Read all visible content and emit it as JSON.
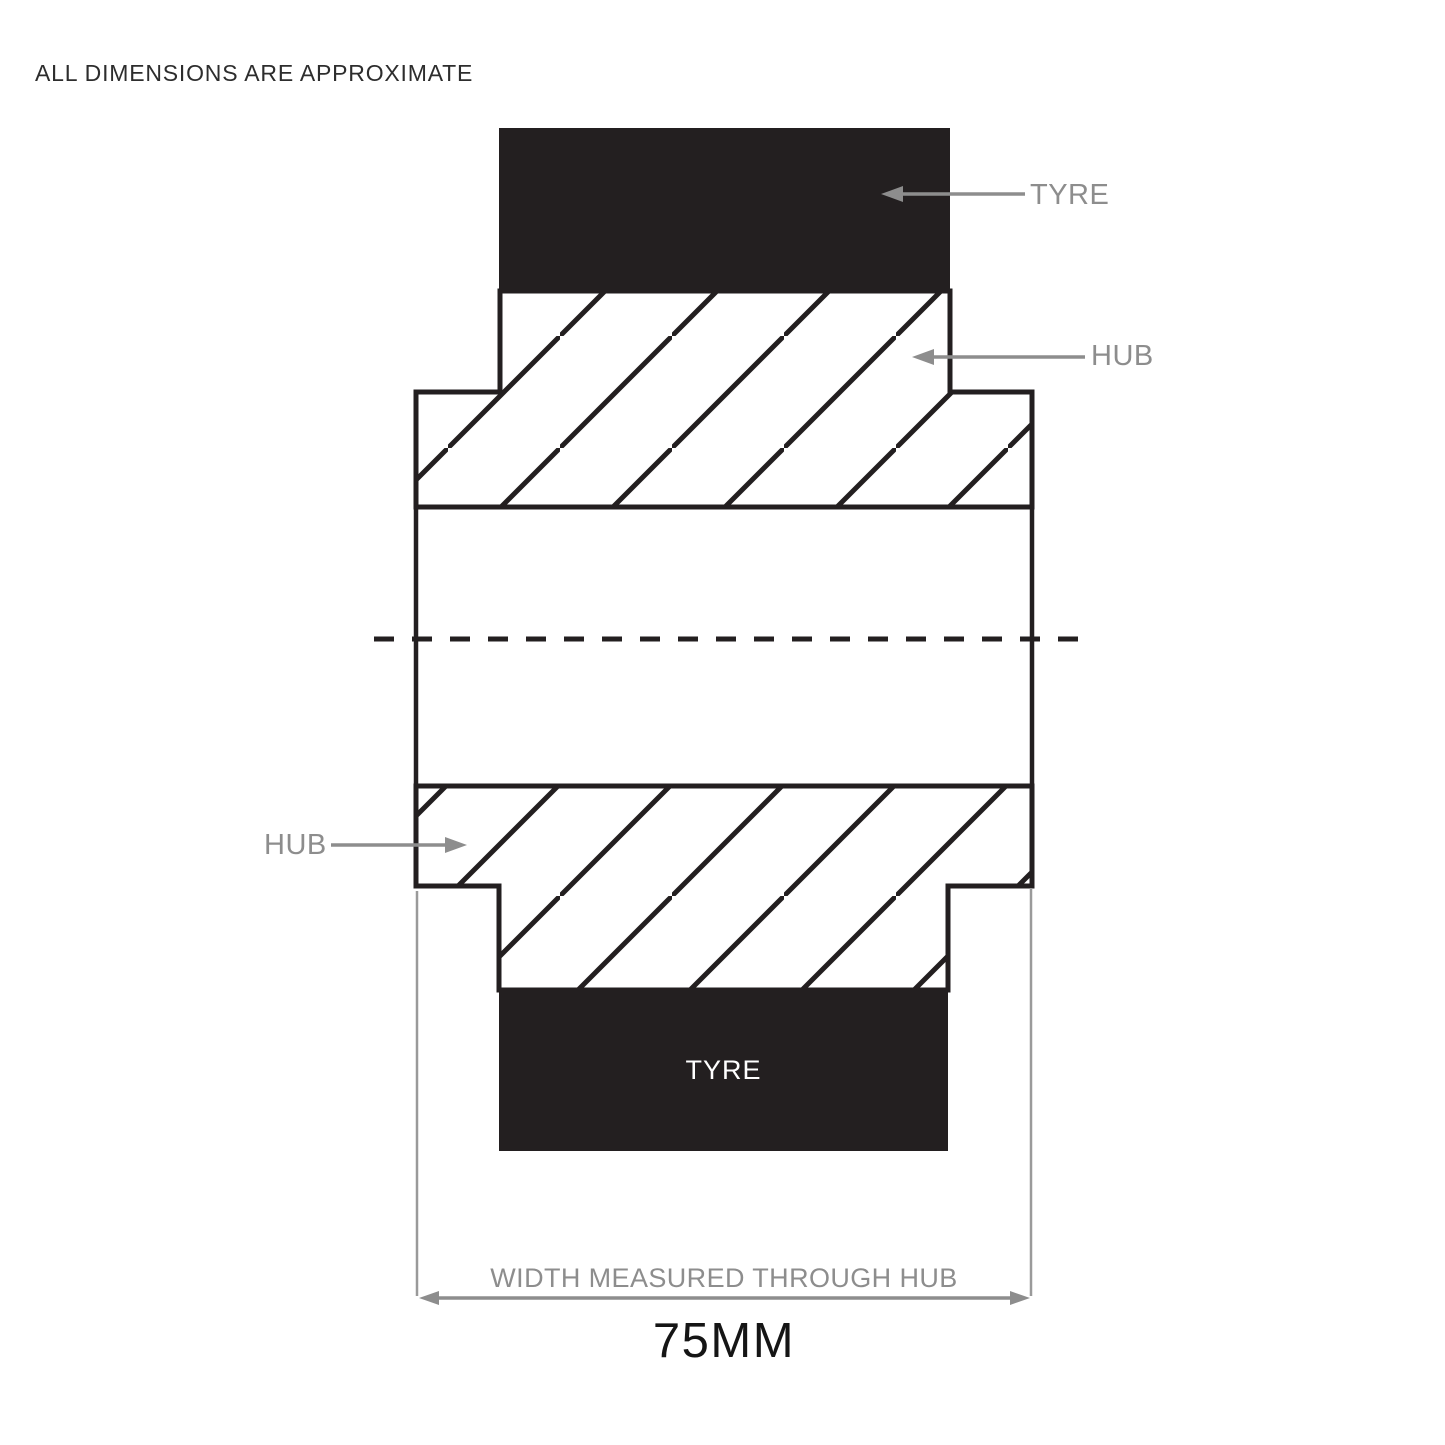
{
  "note": "ALL DIMENSIONS ARE APPROXIMATE",
  "labels": {
    "tyre_top": "TYRE",
    "hub_right": "HUB",
    "hub_left": "HUB",
    "tyre_bottom": "TYRE"
  },
  "dimension": {
    "caption": "WIDTH MEASURED THROUGH HUB",
    "value": "75MM"
  },
  "colors": {
    "ink": "#231f20",
    "label_gray": "#8d8d8d",
    "background": "#ffffff"
  }
}
